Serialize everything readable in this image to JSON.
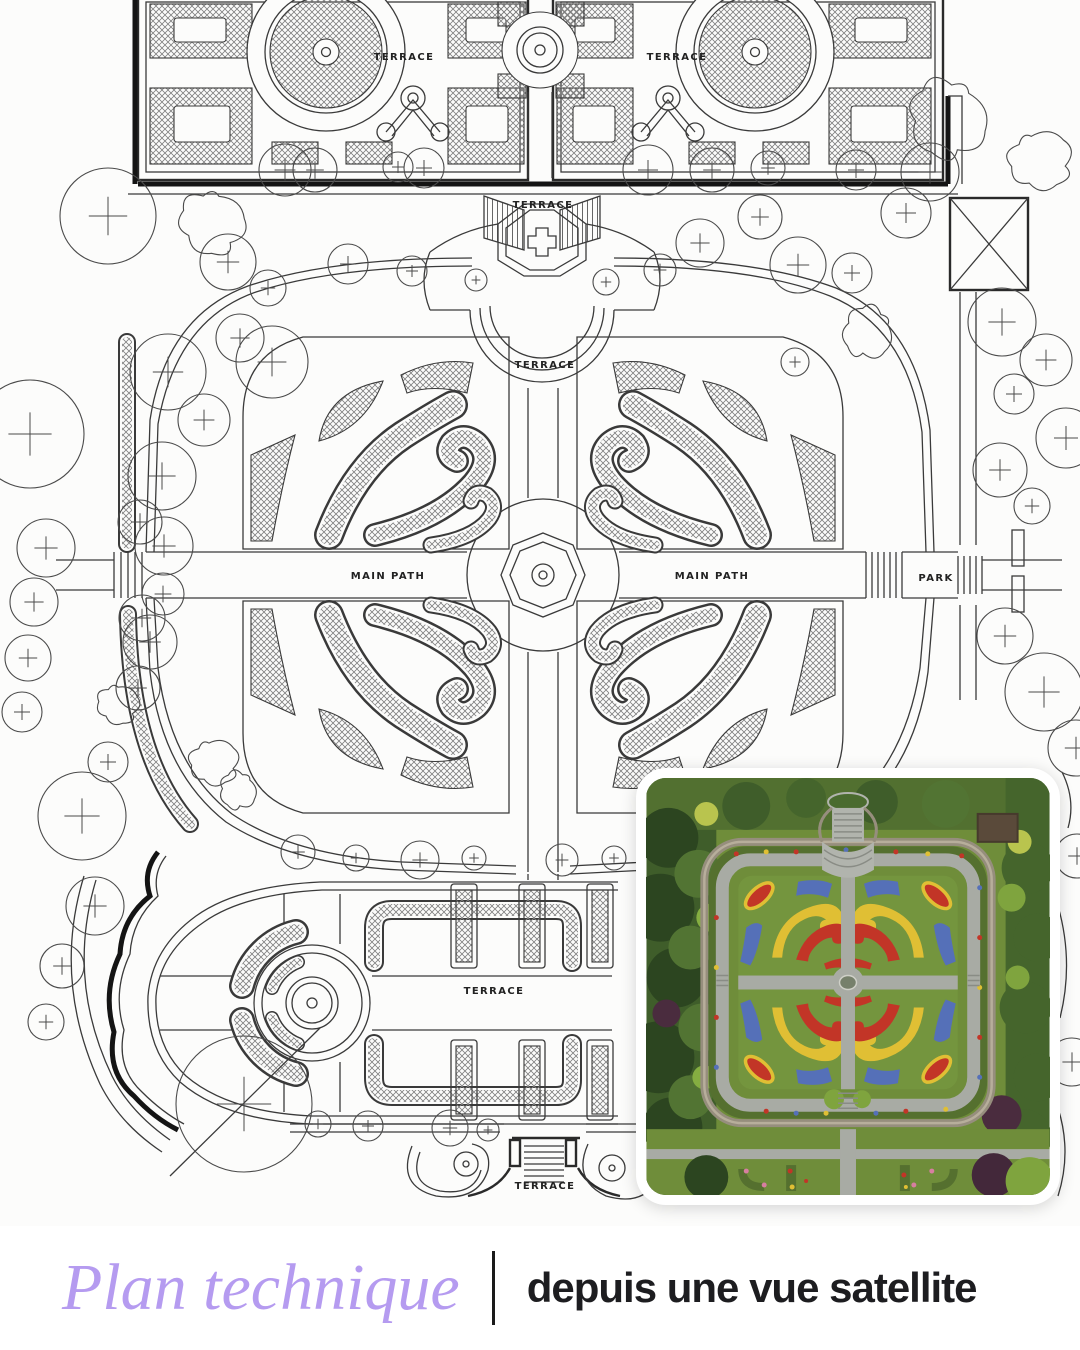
{
  "post": {
    "width": 1080,
    "height": 1350,
    "background": "#ffffff",
    "kind": "garden plan vs satellite comparison graphic"
  },
  "plan": {
    "background": "#fcfcfb",
    "ink": "#3a3a3a",
    "labels": {
      "terrace_top_left": "TERRACE",
      "terrace_top_right": "TERRACE",
      "terrace_upper_steps": "TERRACE",
      "terrace_mid_steps": "TERRACE",
      "main_path_left": "MAIN PATH",
      "main_path_right": "MAIN PATH",
      "park": "PARK",
      "terrace_lower_garden": "TERRACE",
      "terrace_bottom_steps": "TERRACE"
    }
  },
  "inset": {
    "type": "aerial-photo",
    "border_color": "#ffffff",
    "palette": {
      "lawn": "#74953e",
      "path": "#a8aba4",
      "stone_wall": "#968e7d",
      "tree_dark": "#2c4520",
      "tree_mid": "#45652c",
      "tree_bright": "#7fa43e",
      "tree_yellow": "#b9c44e",
      "shrub_purple": "#43283a",
      "flower_red": "#c23527",
      "flower_yellow": "#e0bf34",
      "flower_blue": "#5570b8",
      "pond": "#76806b"
    }
  },
  "caption": {
    "title": "Plan technique",
    "subtitle": "depuis une vue satellite",
    "title_color": "#b59bf0",
    "text_color": "#1d1d20",
    "divider_color": "#1a1a1a"
  }
}
